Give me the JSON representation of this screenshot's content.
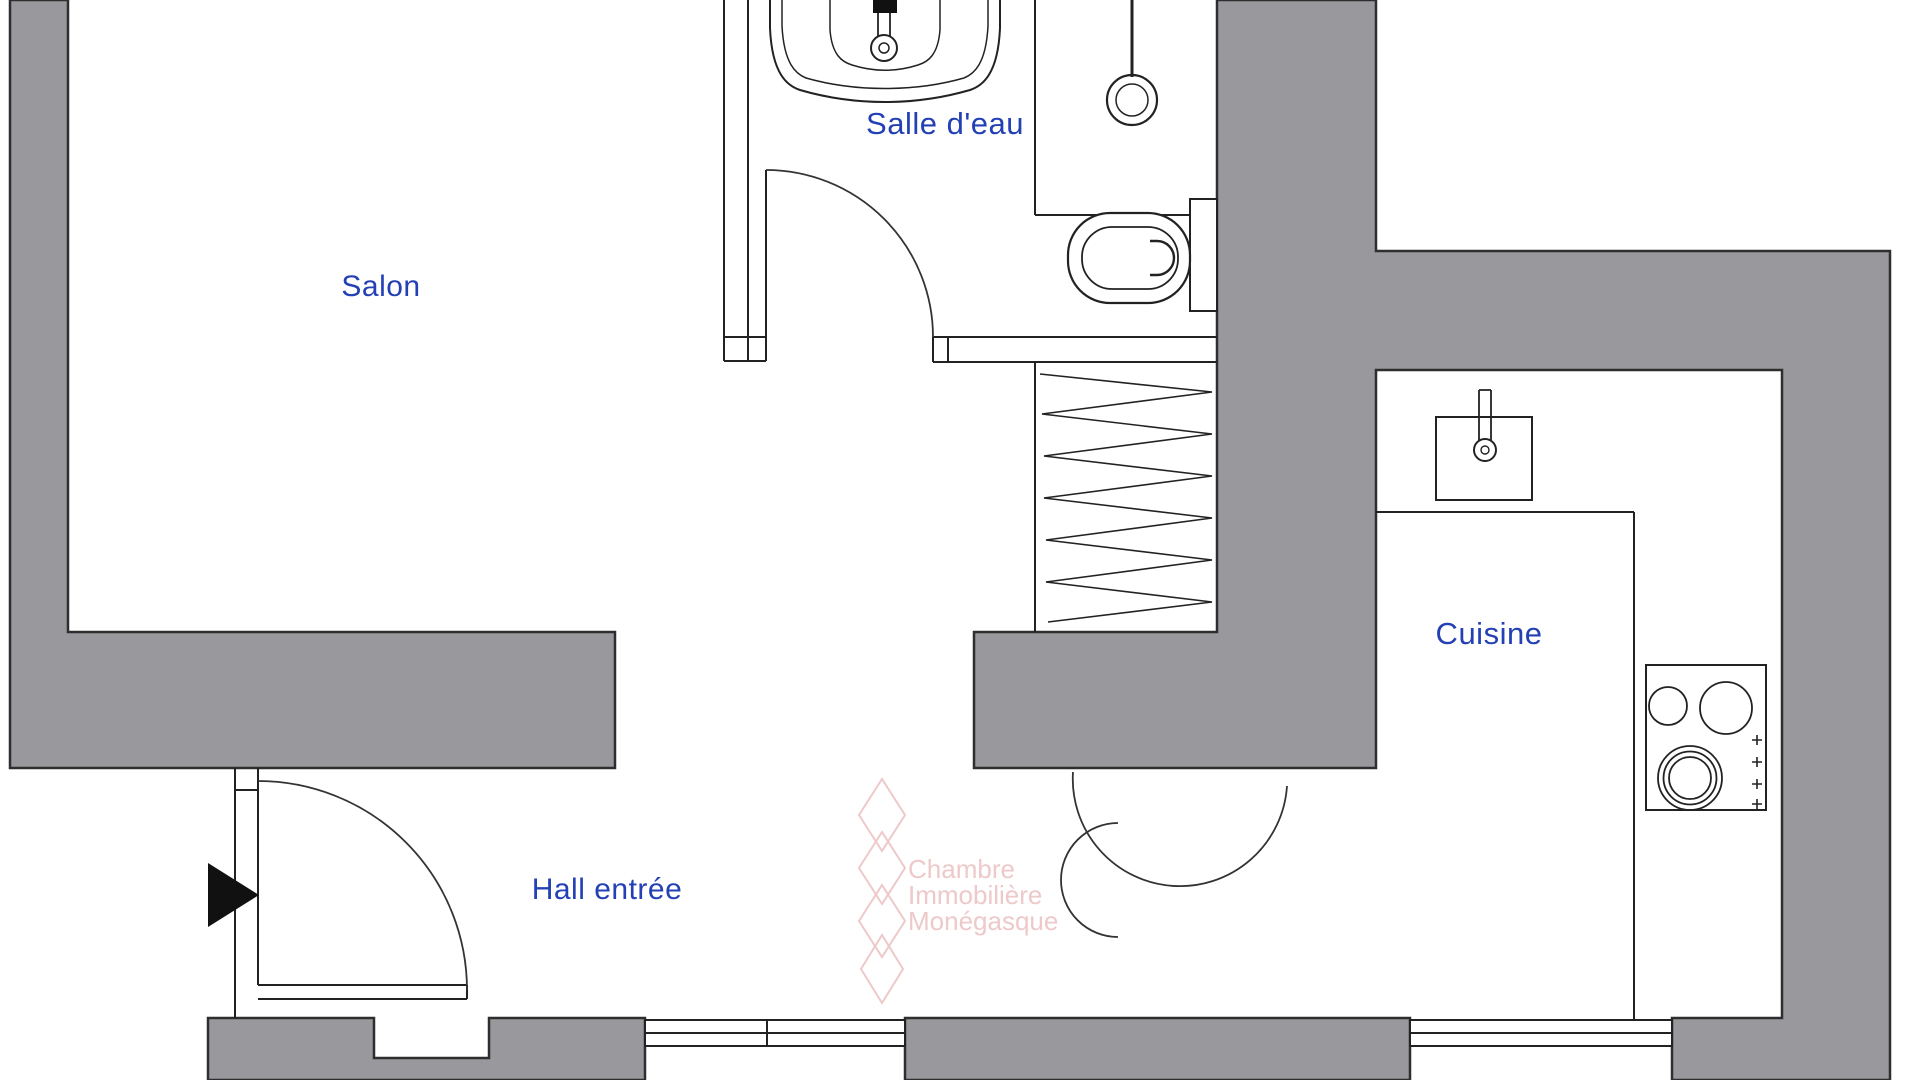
{
  "title": "Plan d'appartement",
  "rooms": {
    "salon": {
      "label": "Salon"
    },
    "salle_deau": {
      "label": "Salle d'eau"
    },
    "cuisine": {
      "label": "Cuisine"
    },
    "hall": {
      "label": "Hall entrée"
    }
  },
  "watermark": {
    "line1": "Chambre",
    "line2": "Immobilière",
    "line3": "Monégasque"
  },
  "fixtures": [
    "vanity-sink",
    "shower-drain",
    "toilet",
    "closet-hatch",
    "kitchen-sink",
    "cooktop",
    "entry-door",
    "bathroom-door",
    "kitchen-door"
  ],
  "colors": {
    "wall_fill": "#98989d",
    "wall_line": "#2e2e2e",
    "thin_line": "#222222",
    "label_text": "#2340b4",
    "watermark_text": "#eec9ca"
  }
}
